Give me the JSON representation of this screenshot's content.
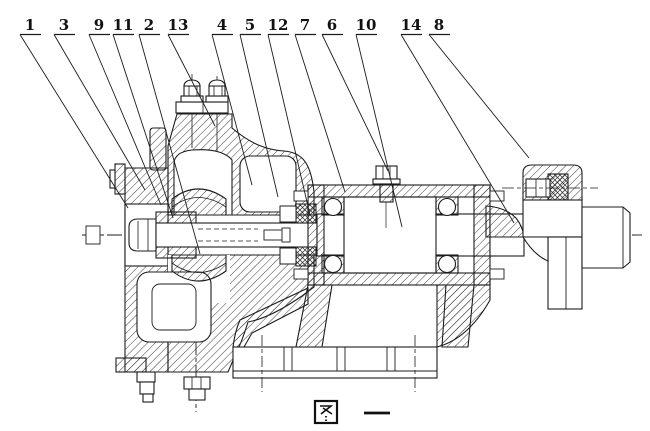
{
  "figure": {
    "caption": "图 一"
  },
  "colors": {
    "ink": "#1c1c1c",
    "background": "#ffffff"
  },
  "part_labels": [
    {
      "number": "1",
      "x": 30,
      "tx": 128,
      "ty": 208
    },
    {
      "number": "3",
      "x": 64,
      "tx": 145,
      "ty": 190
    },
    {
      "number": "9",
      "x": 99,
      "tx": 161,
      "ty": 205
    },
    {
      "number": "11",
      "x": 123,
      "tx": 173,
      "ty": 218
    },
    {
      "number": "2",
      "x": 149,
      "tx": 200,
      "ty": 254
    },
    {
      "number": "13",
      "x": 178,
      "tx": 215,
      "ty": 126
    },
    {
      "number": "4",
      "x": 222,
      "tx": 252,
      "ty": 185
    },
    {
      "number": "5",
      "x": 250,
      "tx": 278,
      "ty": 197
    },
    {
      "number": "12",
      "x": 278,
      "tx": 310,
      "ty": 215
    },
    {
      "number": "7",
      "x": 305,
      "tx": 345,
      "ty": 192
    },
    {
      "number": "6",
      "x": 332,
      "tx": 388,
      "ty": 171
    },
    {
      "number": "10",
      "x": 366,
      "tx": 402,
      "ty": 227
    },
    {
      "number": "14",
      "x": 411,
      "tx": 514,
      "ty": 223
    },
    {
      "number": "8",
      "x": 439,
      "tx": 529,
      "ty": 158
    }
  ]
}
